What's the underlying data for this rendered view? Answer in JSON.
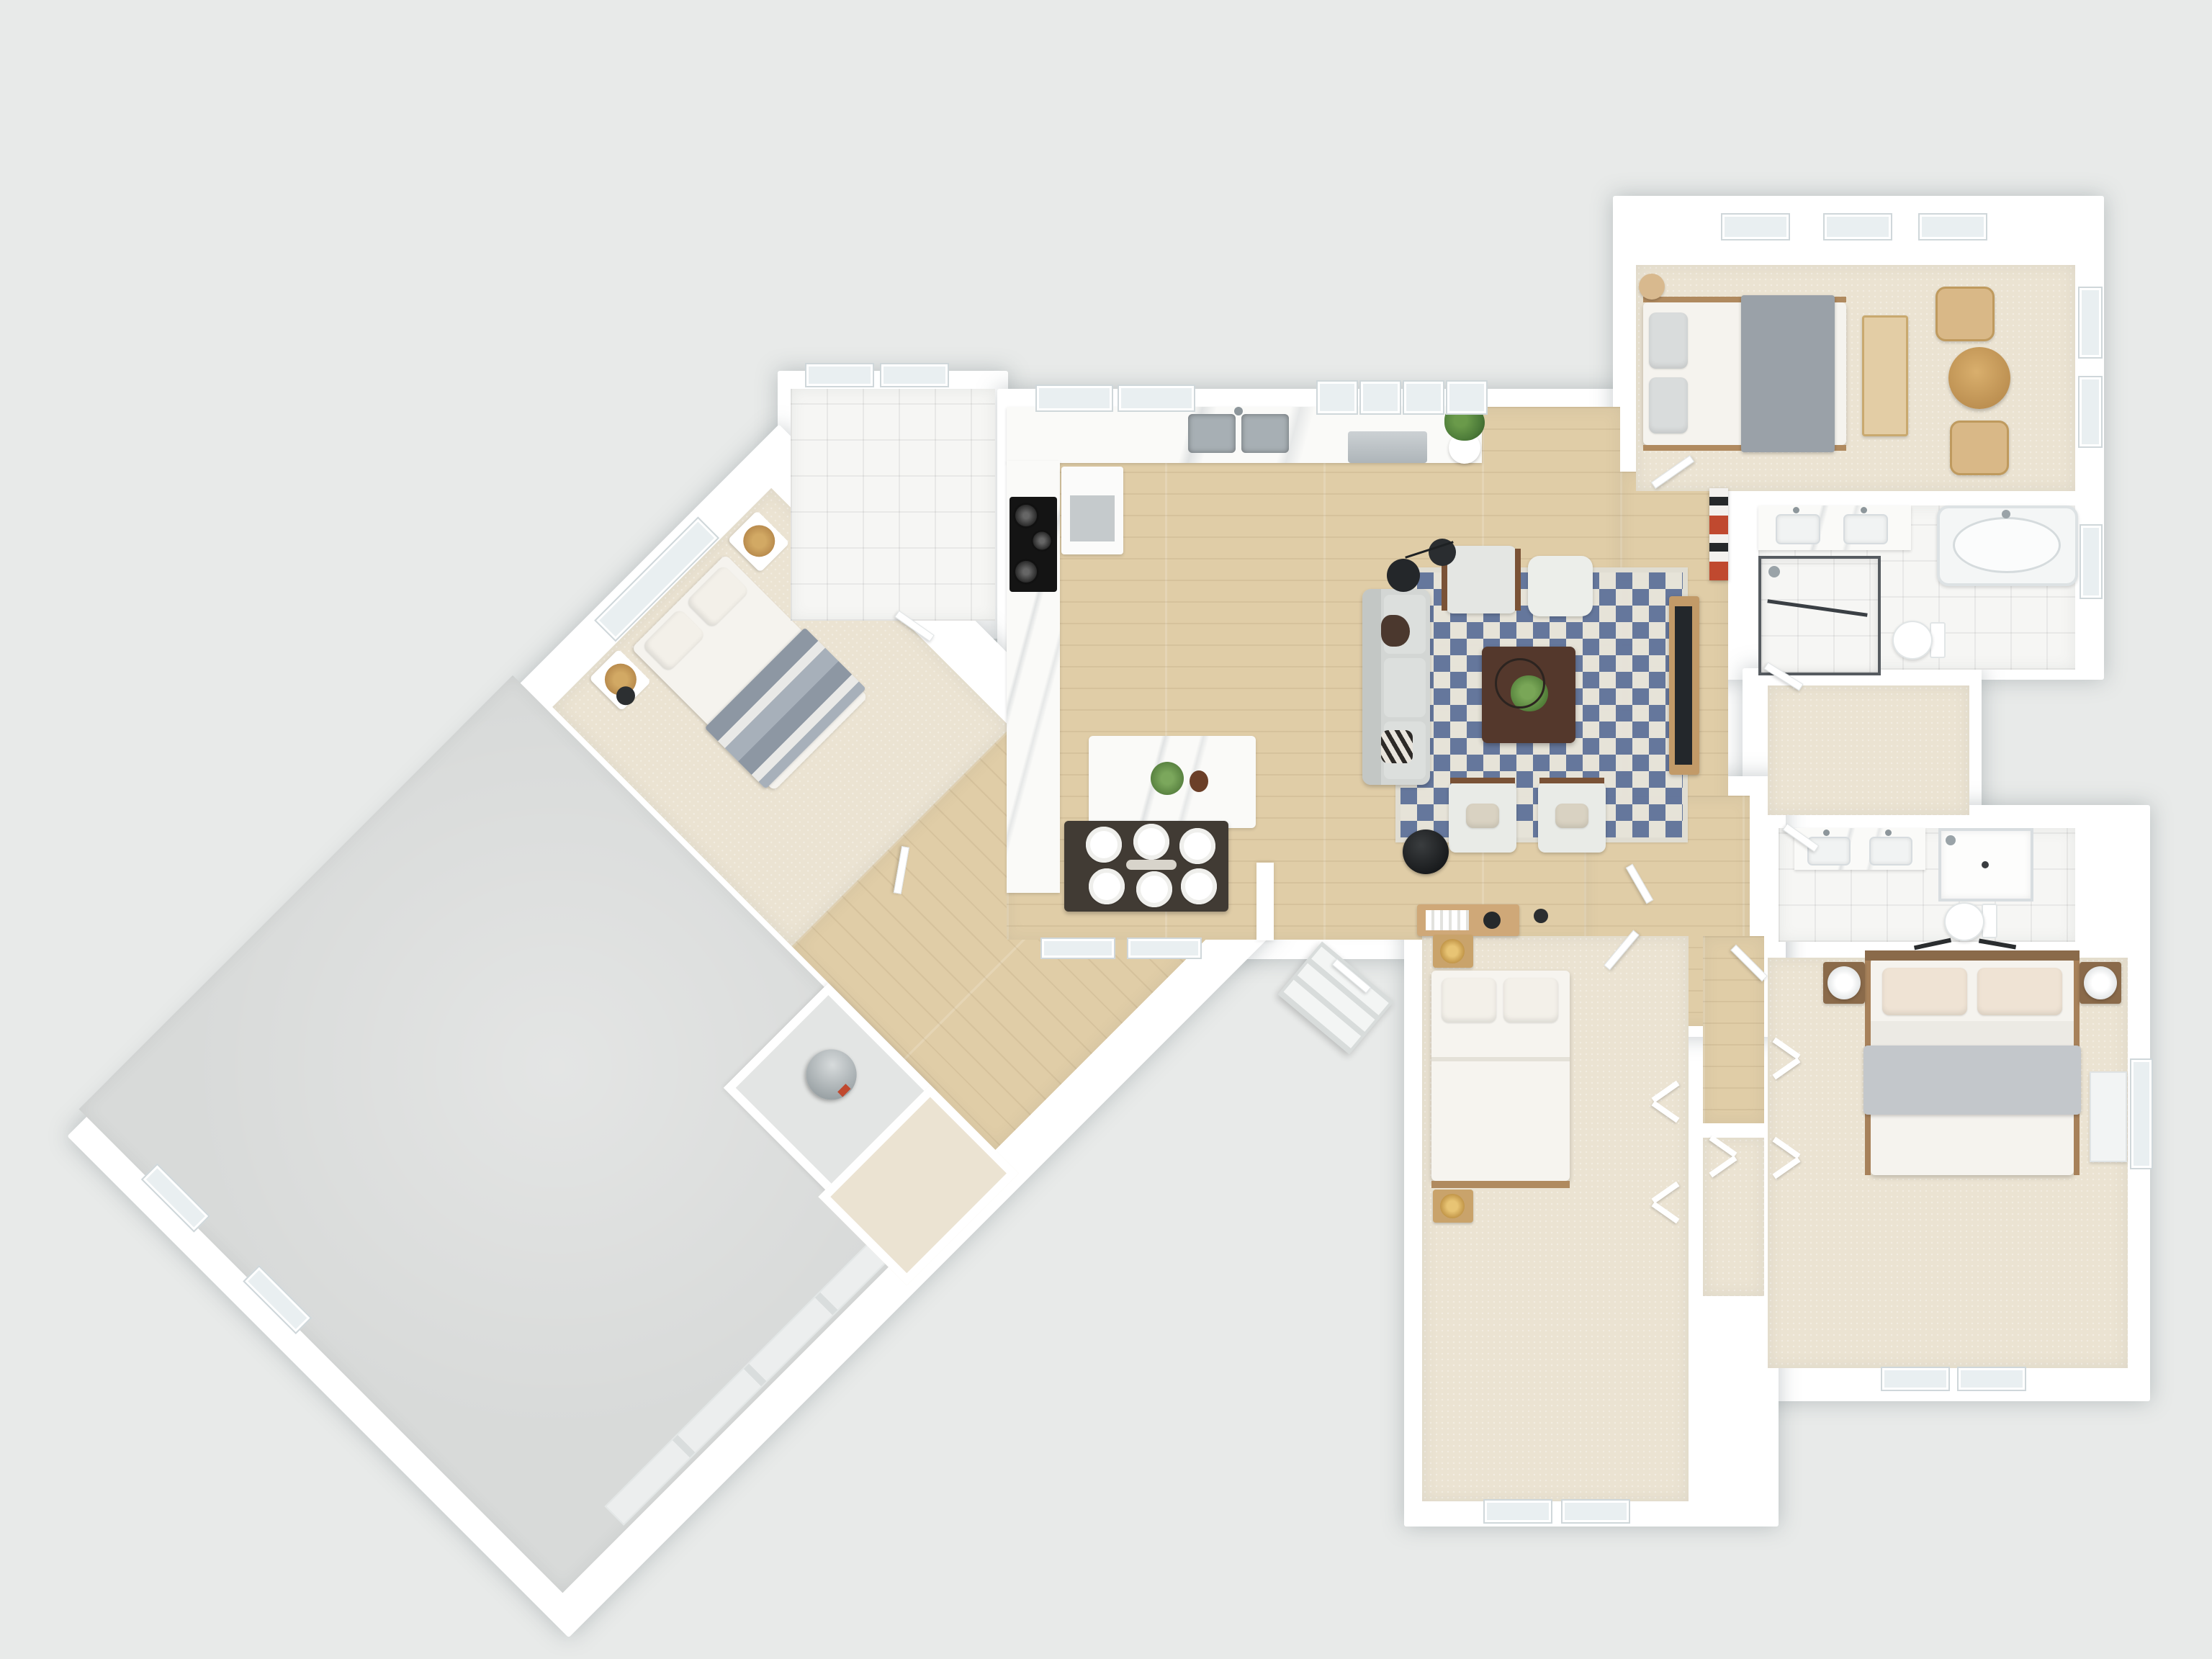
{
  "scene": {
    "type": "3d-floor-plan-top-down-render",
    "description": "Photorealistic dollhouse top view of a single-story house with angled garage wing; no visible text labels",
    "background": "#e8eae9"
  },
  "palette": {
    "wall": "#ffffff",
    "wood": "#e0cda7",
    "carpet": "#ebe3d2",
    "tile": "#f6f6f4",
    "concrete": "#d8dad9",
    "marble": "#fafaf8",
    "rug_blue": "#61749c",
    "rug_cream": "#e7e4db",
    "sofa_gray": "#d3d6d4",
    "blanket_gray": "#a7adb4",
    "bed_white": "#f5f3ee",
    "wood_furniture": "#c29a68",
    "wood_dark": "#8a6a4a",
    "table_dark": "#413b34",
    "chair_cream": "#efe8d8",
    "plant_green": "#5d8a41",
    "appliance_gray": "#c2c7ca",
    "glass": "#e9eff1",
    "accent_red": "#c0492f",
    "black": "#202427"
  },
  "rooms": [
    {
      "name": "great-room",
      "floor": "wood",
      "furniture": [
        "kitchen-l-counter",
        "double-sink",
        "dishwasher",
        "cooktop-stove",
        "fridge",
        "kitchen-island",
        "4-island-stools",
        "potted-plant",
        "dining-table-6-plates",
        "6-dining-chairs",
        "gray-sofa",
        "blue-checker-rug",
        "coffee-table-with-plant",
        "armchair",
        "ottoman",
        "2-accent-armchairs",
        "arc-floor-lamp",
        "round-side-table",
        "tv-on-wood-console",
        "red-accent-shelf",
        "entry-console-with-books"
      ]
    },
    {
      "name": "laundry-room",
      "floor": "tile",
      "furniture": [
        "wood-cabinet",
        "washer-dryer"
      ]
    },
    {
      "name": "bedroom-top-right",
      "floor": "carpet",
      "furniture": [
        "bed-gray-blanket",
        "dresser",
        "rattan-bench",
        "round-wood-table",
        "2-rattan-chairs"
      ]
    },
    {
      "name": "main-bathroom",
      "floor": "tile",
      "furniture": [
        "double-vanity",
        "oval-bathtub",
        "glass-shower",
        "toilet"
      ]
    },
    {
      "name": "walk-in-closet",
      "floor": "carpet",
      "furniture": []
    },
    {
      "name": "ensuite-bathroom",
      "floor": "tile",
      "furniture": [
        "double-vanity",
        "shower",
        "toilet"
      ]
    },
    {
      "name": "bedroom-bottom-right",
      "floor": "carpet",
      "furniture": [
        "bed-wood-frame-gray-blanket",
        "2-nightstands-white-lamps",
        "bifold-closet",
        "white-dresser"
      ]
    },
    {
      "name": "bedroom-bottom-center",
      "floor": "carpet",
      "furniture": [
        "bed-white-duvet",
        "2-nightstands-gold-lamps",
        "bifold-closet"
      ]
    },
    {
      "name": "bedroom-diagonal-wing",
      "floor": "carpet",
      "furniture": [
        "bed-gray-stripe-blanket",
        "2-round-nightstands",
        "window"
      ]
    },
    {
      "name": "garage-diagonal-wing",
      "floor": "concrete",
      "furniture": [
        "garage-door",
        "2-small-windows",
        "entry-step"
      ]
    },
    {
      "name": "utility-closet",
      "floor": "concrete",
      "furniture": [
        "water-heater"
      ]
    },
    {
      "name": "hallways",
      "floor": "wood",
      "furniture": [
        "front-porch-steps",
        "front-door",
        "interior-doors"
      ]
    }
  ]
}
